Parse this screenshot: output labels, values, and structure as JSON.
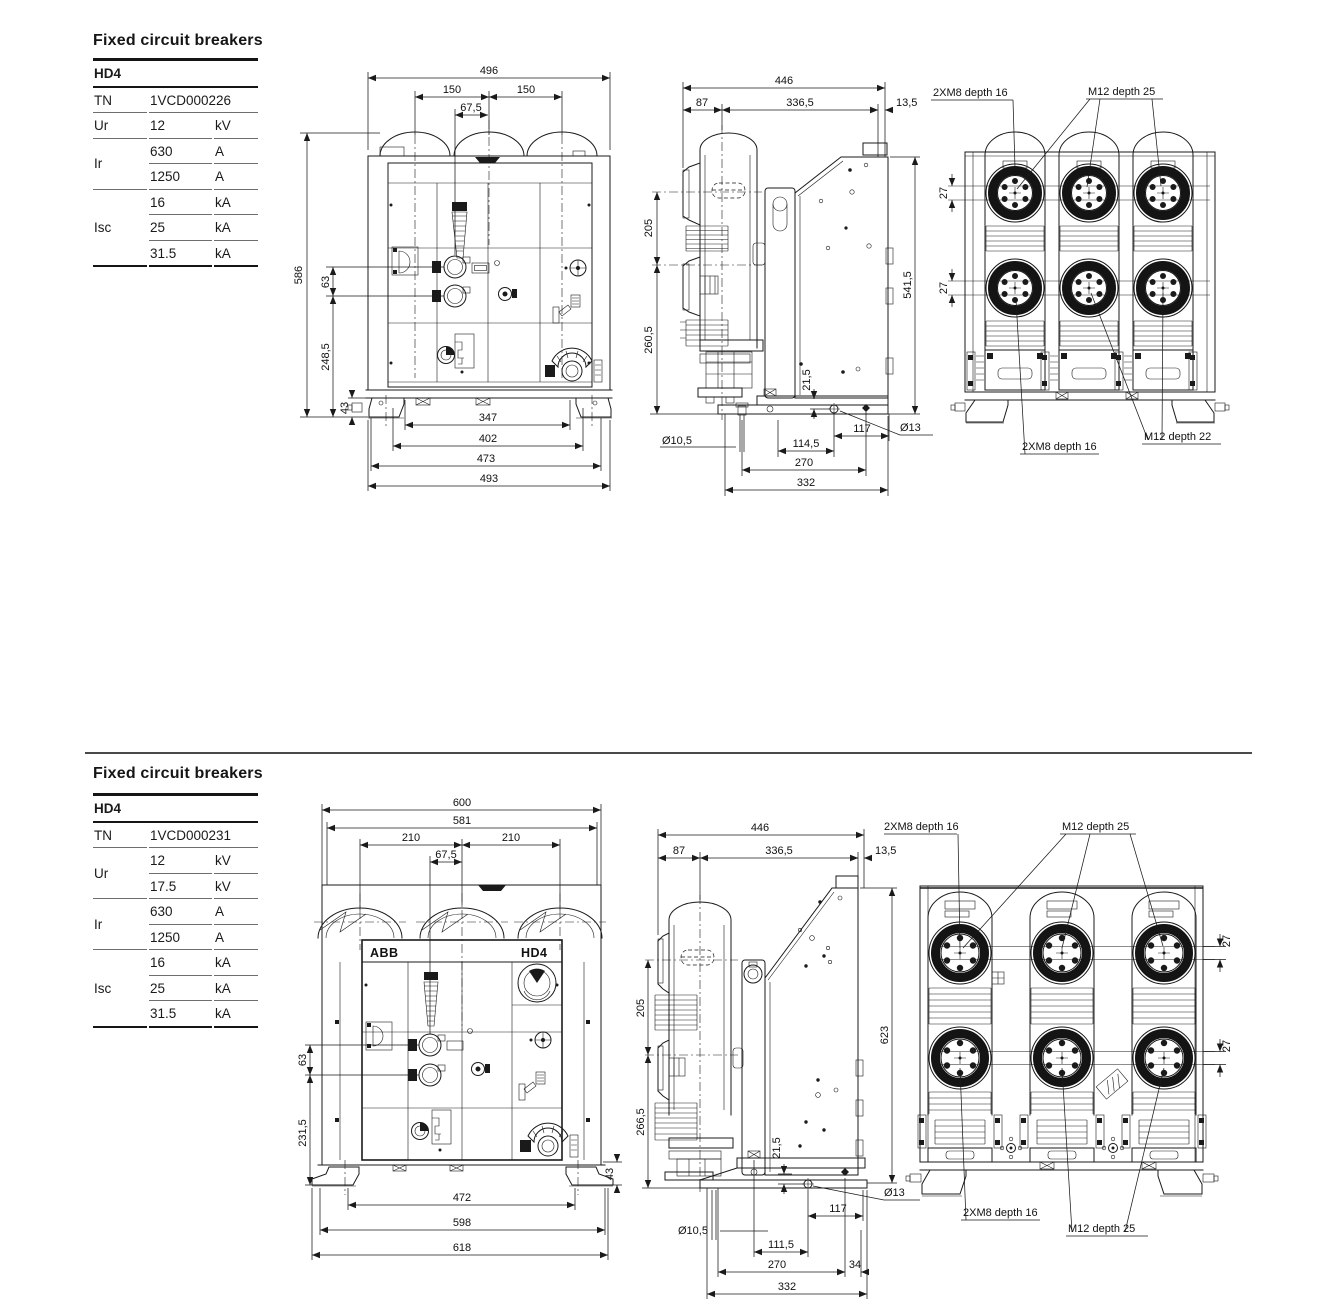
{
  "sections": [
    {
      "title": "Fixed circuit breakers",
      "table": {
        "model": "HD4",
        "tn_label": "TN",
        "tn": "1VCD000226",
        "ur_label": "Ur",
        "ur": [
          {
            "v": "12",
            "u": "kV"
          }
        ],
        "ir_label": "Ir",
        "ir": [
          {
            "v": "630",
            "u": "A"
          },
          {
            "v": "1250",
            "u": "A"
          }
        ],
        "isc_label": "Isc",
        "isc": [
          {
            "v": "16",
            "u": "kA"
          },
          {
            "v": "25",
            "u": "kA"
          },
          {
            "v": "31.5",
            "u": "kA"
          }
        ]
      },
      "front": {
        "w": "496",
        "p1": "150",
        "p2": "150",
        "off": "67,5",
        "h": "586",
        "shaft": "63",
        "low": "248,5",
        "foot": "43",
        "b1": "347",
        "b2": "402",
        "b3": "473",
        "b4": "493"
      },
      "side": {
        "w": "446",
        "a": "87",
        "b": "336,5",
        "c": "13,5",
        "up": "205",
        "low": "260,5",
        "h": "541,5",
        "hole": "21,5",
        "d1": "Ø10,5",
        "m1": "114,5",
        "m2": "117",
        "m3": "270",
        "m4": "332",
        "d2": "Ø13"
      },
      "rear": {
        "t1": "2XM8 depth 16",
        "t2": "M12 depth 25",
        "o1": "27",
        "o2": "27",
        "b1": "2XM8 depth 16",
        "b2": "M12 depth 22"
      }
    },
    {
      "title": "Fixed circuit breakers",
      "table": {
        "model": "HD4",
        "tn_label": "TN",
        "tn": "1VCD000231",
        "ur_label": "Ur",
        "ur": [
          {
            "v": "12",
            "u": "kV"
          },
          {
            "v": "17.5",
            "u": "kV"
          }
        ],
        "ir_label": "Ir",
        "ir": [
          {
            "v": "630",
            "u": "A"
          },
          {
            "v": "1250",
            "u": "A"
          }
        ],
        "isc_label": "Isc",
        "isc": [
          {
            "v": "16",
            "u": "kA"
          },
          {
            "v": "25",
            "u": "kA"
          },
          {
            "v": "31.5",
            "u": "kA"
          }
        ]
      },
      "front": {
        "logo": "ABB",
        "model": "HD4",
        "w": "600",
        "w2": "581",
        "p1": "210",
        "p2": "210",
        "off": "67,5",
        "shaft": "63",
        "low": "231,5",
        "foot": "43",
        "b1": "472",
        "b2": "598",
        "b3": "618"
      },
      "side": {
        "w": "446",
        "a": "87",
        "b": "336,5",
        "c": "13,5",
        "up": "205",
        "low": "266,5",
        "h": "623",
        "hole": "21,5",
        "d1": "Ø10,5",
        "m1": "111,5",
        "m2": "117",
        "m3": "270",
        "m3b": "34",
        "m4": "332",
        "d2": "Ø13"
      },
      "rear": {
        "t1": "2XM8 depth 16",
        "t2": "M12 depth 25",
        "o1": "27",
        "o2": "27",
        "b1": "2XM8 depth 16",
        "b2": "M12 depth 25"
      }
    }
  ]
}
